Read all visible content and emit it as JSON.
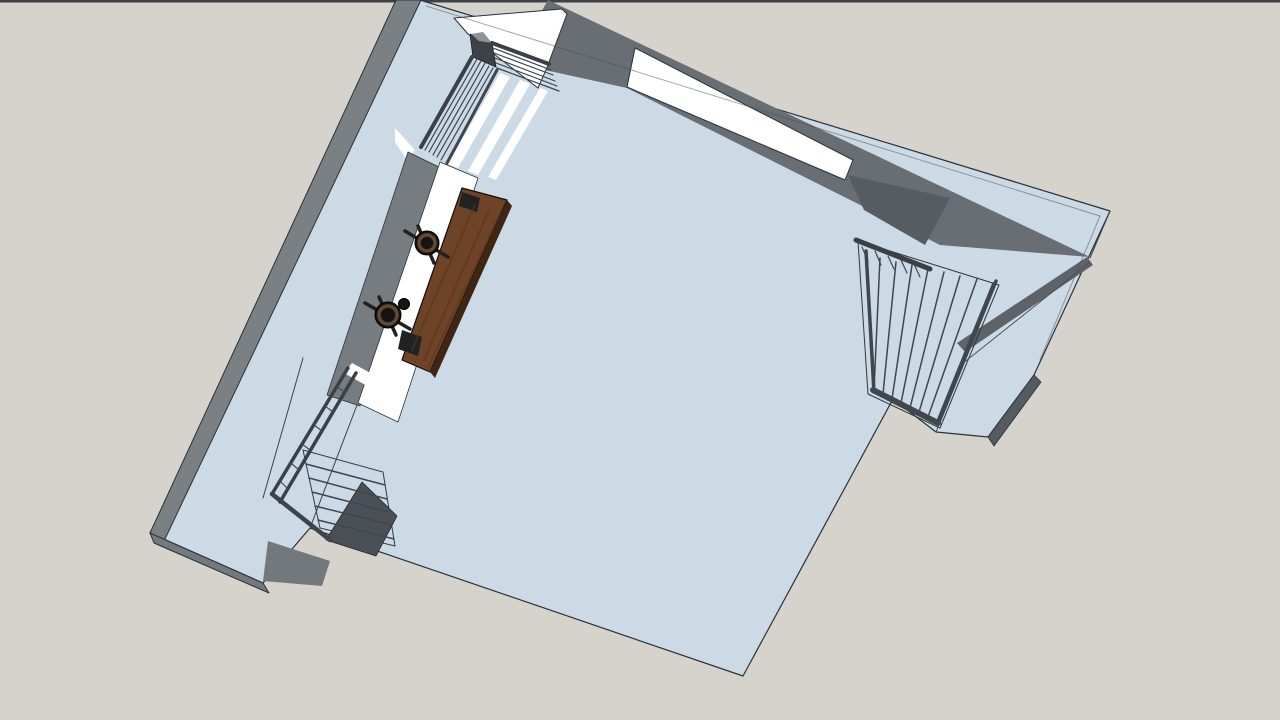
{
  "app": {
    "description": "3D architectural model viewport, top-down view of a room with stairs, railings, window and desk",
    "visible_text": []
  },
  "colors": {
    "background": "#d6d3cd",
    "frame_bar": "#3e4347",
    "surface_blue": "#ccdae6",
    "outline": "#2a3138",
    "wall_gray_outer": "#7b8084",
    "wall_gray_inner": "#686e73",
    "wall_gray_dark": "#565c62",
    "rail_dark": "#3a4046",
    "white": "#ffffff",
    "desk_brown": "#6e4327",
    "stool_dark": "#161310"
  },
  "scene": {
    "polys": [
      {
        "n": "background",
        "f": "#d6d3cd",
        "p": "0,0 1280,0 1280,720 0,720"
      },
      {
        "n": "frame-top-bar",
        "f": "#3e4347",
        "p": "0,0 1280,0 1280,2.5 0,2.5"
      },
      {
        "n": "room-silhouette",
        "f": "#ccdae6",
        "s": "#2a3138",
        "w": 1.2,
        "p": "420,0 1110,211 1034,375 988,437 936,432 893,399 743,676 310,528 263,583 150,533"
      },
      {
        "n": "wall-outer-face-left",
        "f": "#7b8084",
        "s": "#2a3138",
        "w": 1,
        "p": "396,0 421,0 164,541 150,533"
      },
      {
        "n": "wall-outer-face-bottomleft",
        "f": "#74797d",
        "s": "#2a3138",
        "w": 1,
        "p": "150,533 263,583 269,593 154,543"
      },
      {
        "n": "topwall-inner-face",
        "f": "#686e73",
        "p": "548,0 1090,257 940,245 627,88 545,70 540,14"
      },
      {
        "n": "topwall-inner-face-dark-wedge",
        "f": "#565c62",
        "p": "848,175 950,198 925,245 864,210"
      },
      {
        "n": "window-strip",
        "f": "#ffffff",
        "s": "#2a3138",
        "w": 1,
        "p": "635,48 853,160 845,180 627,87"
      },
      {
        "n": "rightwall-inner-face",
        "f": "#5d6369",
        "p": "1087,257 1093,265 965,352 957,343"
      },
      {
        "n": "landing-edge-face",
        "f": "#555b61",
        "s": "#2a3138",
        "w": 0.8,
        "p": "1034,375 1041,382 994,446 988,437"
      },
      {
        "n": "stairwell-right-outline",
        "f": "none",
        "s": "#30363c",
        "w": 1,
        "p": "858,241 999,285 940,428 868,394"
      },
      {
        "n": "stair-opening-white-walkway",
        "f": "#ffffff",
        "s": "#2a3138",
        "w": 1,
        "p": "454,18 562,9 567,14 546,70 538,88 468,34"
      },
      {
        "n": "walkway-white-sliver",
        "f": "#ffffff",
        "p": "395,128 415,150 407,160 395,142"
      },
      {
        "n": "rail-corner-post",
        "f": "#3c4248",
        "s": "#16191d",
        "w": 0.8,
        "p": "470,34 492,43 496,67 473,57"
      },
      {
        "n": "rail-corner-post-top",
        "f": "#8d9399",
        "p": "471,34 483,32 492,43 479,41"
      },
      {
        "n": "stair-stripe-1",
        "f": "#ffffff",
        "p": "500,73 510,77 458,168 448,164"
      },
      {
        "n": "stair-stripe-2",
        "f": "#ffffff",
        "p": "520,80 530,84 478,175 468,171"
      },
      {
        "n": "stair-stripe-3",
        "f": "#ffffff",
        "p": "540,88 548,91 496,180 488,177"
      },
      {
        "n": "leftwall-inner-face",
        "f": "#777c80",
        "s": "#2a3138",
        "w": 0.8,
        "p": "408,152 445,170 360,406 327,395"
      },
      {
        "n": "desk-platform-white",
        "f": "#ffffff",
        "s": "#2a3138",
        "w": 0.8,
        "p": "440,162 478,178 398,422 358,403"
      },
      {
        "n": "desk-top",
        "f": "#6e4327",
        "s": "#140e08",
        "w": 1.2,
        "p": "462,188 507,200 430,372 402,360"
      },
      {
        "n": "desk-side-face",
        "f": "#3f2614",
        "p": "507,200 512,206 435,378 430,372"
      },
      {
        "n": "desk-bracket-top",
        "f": "#1f2326",
        "p": "462,192 480,198 477,212 459,206"
      },
      {
        "n": "desk-bracket-bottom",
        "f": "#1f2326",
        "p": "402,330 422,337 418,356 398,349"
      },
      {
        "n": "exit-stair-treads",
        "f": "#cbdae6",
        "s": "#333a41",
        "w": 1,
        "p": "303,450 383,472 395,546 320,528"
      },
      {
        "n": "exit-stair-side-panel",
        "f": "#4a5056",
        "s": "#23282d",
        "w": 0.8,
        "p": "362,482 397,516 376,556 326,540"
      },
      {
        "n": "exit-stair-white-entry",
        "f": "#ffffff",
        "p": "352,363 378,377 369,387 344,373"
      },
      {
        "n": "exit-stair-bottom-face",
        "f": "#73787c",
        "p": "268,541 330,561 322,586 263,581"
      }
    ],
    "lines": [
      {
        "n": "band-seam-top",
        "s": "#4a5056",
        "w": 1,
        "o": 0.5,
        "p": "426,6 1100,216"
      },
      {
        "n": "band-seam-right",
        "s": "#4a5056",
        "w": 1,
        "o": 0.5,
        "p": "1100,216 1040,360"
      },
      {
        "n": "band-corner-seam",
        "s": "#39404a",
        "w": 1,
        "p": "1110,211 1090,258"
      },
      {
        "n": "landing-edge-line-1",
        "s": "#4a5158",
        "w": 1,
        "p": "936,432 962,364"
      },
      {
        "n": "landing-edge-line-2",
        "s": "#4a5158",
        "w": 1,
        "p": "962,364 1090,262"
      },
      {
        "n": "floor-left-edge-line",
        "s": "#39404a",
        "w": 1,
        "p": "357,405 310,528"
      },
      {
        "n": "walkway-inner-edge-line",
        "s": "#39404a",
        "w": 1,
        "p": "303,358 263,498"
      },
      {
        "n": "rs-tread-1",
        "s": "#3f464d",
        "w": 1.5,
        "p": "880,258 874,390"
      },
      {
        "n": "rs-tread-2",
        "s": "#3f464d",
        "w": 1.5,
        "p": "896,262 883,394"
      },
      {
        "n": "rs-tread-3",
        "s": "#3f464d",
        "w": 1.5,
        "p": "912,265 892,399"
      },
      {
        "n": "rs-tread-4",
        "s": "#3f464d",
        "w": 1.5,
        "p": "928,269 901,403"
      },
      {
        "n": "rs-tread-5",
        "s": "#3f464d",
        "w": 1.5,
        "p": "944,272 910,408"
      },
      {
        "n": "rs-tread-6",
        "s": "#3f464d",
        "w": 1.5,
        "p": "960,276 919,412"
      },
      {
        "n": "rs-tread-7",
        "s": "#3f464d",
        "w": 1.5,
        "p": "977,279 928,417"
      },
      {
        "n": "rs-tread-8",
        "s": "#3f464d",
        "w": 1.5,
        "p": "993,283 937,421"
      },
      {
        "n": "rs-top-rail",
        "s": "#3a4046",
        "w": 5,
        "p": "856,240 930,269"
      },
      {
        "n": "rs-left-rail",
        "s": "#3f464d",
        "w": 3.5,
        "p": "866,251 874,392"
      },
      {
        "n": "rs-right-rail",
        "s": "#3f464d",
        "w": 3.5,
        "p": "996,281 939,422"
      },
      {
        "n": "rs-bottom-bar",
        "s": "#41474e",
        "w": 6,
        "p": "873,390 938,423"
      },
      {
        "n": "rs-baluster-1",
        "s": "#3f464d",
        "w": 1.2,
        "p": "862,247 868,261"
      },
      {
        "n": "rs-baluster-2",
        "s": "#3f464d",
        "w": 1.2,
        "p": "875,251 881,265"
      },
      {
        "n": "rs-baluster-3",
        "s": "#3f464d",
        "w": 1.2,
        "p": "888,256 894,269"
      },
      {
        "n": "rs-baluster-4",
        "s": "#3f464d",
        "w": 1.2,
        "p": "901,260 907,273"
      },
      {
        "n": "rs-baluster-5",
        "s": "#3f464d",
        "w": 1.2,
        "p": "914,264 920,277"
      },
      {
        "n": "ls-top-rail",
        "s": "#3a4046",
        "w": 4,
        "p": "492,43 549,64"
      },
      {
        "n": "ls-top-bar-1",
        "s": "#3d444b",
        "w": 1.2,
        "p": "493,48 551,70"
      },
      {
        "n": "ls-top-bar-2",
        "s": "#3d444b",
        "w": 1.2,
        "p": "494,53 553,75"
      },
      {
        "n": "ls-top-bar-3",
        "s": "#3d444b",
        "w": 1.2,
        "p": "495,58 555,81"
      },
      {
        "n": "ls-top-bar-4",
        "s": "#3d444b",
        "w": 1.2,
        "p": "496,63 557,86"
      },
      {
        "n": "ls-top-bar-5",
        "s": "#3d444b",
        "w": 1.2,
        "p": "497,68 559,91"
      },
      {
        "n": "ls-left-rail",
        "s": "#3a4046",
        "w": 4,
        "p": "472,57 421,147"
      },
      {
        "n": "ls-left-bar-1",
        "s": "#3d444b",
        "w": 1.2,
        "p": "477,59 425,150"
      },
      {
        "n": "ls-left-bar-2",
        "s": "#3d444b",
        "w": 1.2,
        "p": "481,61 429,152"
      },
      {
        "n": "ls-left-bar-3",
        "s": "#3d444b",
        "w": 1.2,
        "p": "485,63 433,155"
      },
      {
        "n": "ls-left-bar-4",
        "s": "#3d444b",
        "w": 1.2,
        "p": "489,66 437,157"
      },
      {
        "n": "ls-left-bar-5",
        "s": "#3d444b",
        "w": 1.2,
        "p": "493,68 441,160"
      },
      {
        "n": "ls-left-rail-inner",
        "s": "#3f464d",
        "w": 3,
        "p": "497,70 447,163"
      },
      {
        "n": "es-tread-1",
        "s": "#3f464d",
        "w": 1.5,
        "p": "306,464 385,485"
      },
      {
        "n": "es-tread-2",
        "s": "#3f464d",
        "w": 1.5,
        "p": "309,478 387,499"
      },
      {
        "n": "es-tread-3",
        "s": "#3f464d",
        "w": 1.5,
        "p": "312,492 389,512"
      },
      {
        "n": "es-tread-4",
        "s": "#3f464d",
        "w": 1.5,
        "p": "315,506 392,525"
      },
      {
        "n": "es-tread-5",
        "s": "#3f464d",
        "w": 1.5,
        "p": "318,520 394,539"
      },
      {
        "n": "es-left-stringer",
        "s": "#3e444a",
        "w": 4.5,
        "p": "272,494 330,540"
      },
      {
        "n": "es-rail-1",
        "s": "#3a4046",
        "w": 3.5,
        "p": "348,368 272,494"
      },
      {
        "n": "es-rail-2",
        "s": "#3a4046",
        "w": 3.5,
        "p": "356,373 280,502"
      },
      {
        "n": "es-baluster-1",
        "s": "#454b51",
        "w": 1.2,
        "p": "337,387 345,392"
      },
      {
        "n": "es-baluster-2",
        "s": "#454b51",
        "w": 1.2,
        "p": "325,406 333,412"
      },
      {
        "n": "es-baluster-3",
        "s": "#454b51",
        "w": 1.2,
        "p": "314,425 322,431"
      },
      {
        "n": "es-baluster-4",
        "s": "#454b51",
        "w": 1.2,
        "p": "302,444 310,450"
      },
      {
        "n": "es-baluster-5",
        "s": "#454b51",
        "w": 1.2,
        "p": "291,463 299,470"
      },
      {
        "n": "es-baluster-6",
        "s": "#454b51",
        "w": 1.2,
        "p": "280,481 288,489"
      },
      {
        "n": "desk-grain-1",
        "s": "#583419",
        "w": 2,
        "o": 0.55,
        "p": "475,205 412,350"
      },
      {
        "n": "desk-grain-2",
        "s": "#583419",
        "w": 2,
        "o": 0.55,
        "p": "489,210 424,360"
      },
      {
        "n": "desk-grain-3",
        "s": "#583419",
        "w": 2,
        "o": 0.55,
        "p": "499,216 428,368"
      },
      {
        "n": "stool1-leg-a",
        "s": "#22201d",
        "w": 3.5,
        "p": "405,231 448,257"
      },
      {
        "n": "stool1-leg-b",
        "s": "#22201d",
        "w": 3.5,
        "p": "418,226 434,263"
      },
      {
        "n": "stool2-leg-a",
        "s": "#22201d",
        "w": 3.5,
        "p": "365,303 410,329"
      },
      {
        "n": "stool2-leg-b",
        "s": "#22201d",
        "w": 3.5,
        "p": "379,297 396,335"
      }
    ],
    "circles": [
      {
        "n": "stool-1-seat",
        "cx": 427,
        "cy": 243,
        "r": 12,
        "f": "#161310",
        "s": "#000000",
        "w": 1
      },
      {
        "n": "stool-1-ring",
        "cx": 427,
        "cy": 243,
        "r": 8,
        "f": "none",
        "s": "#5e4a35",
        "w": 3.5
      },
      {
        "n": "stool-2-seat",
        "cx": 388,
        "cy": 315,
        "r": 13,
        "f": "#161310",
        "s": "#000000",
        "w": 1
      },
      {
        "n": "stool-2-ring",
        "cx": 388,
        "cy": 315,
        "r": 9,
        "f": "none",
        "s": "#5e4a35",
        "w": 3.5
      },
      {
        "n": "cup-on-counter",
        "cx": 404,
        "cy": 304,
        "r": 5.5,
        "f": "#17150f",
        "s": "#000000",
        "w": 1
      }
    ]
  }
}
